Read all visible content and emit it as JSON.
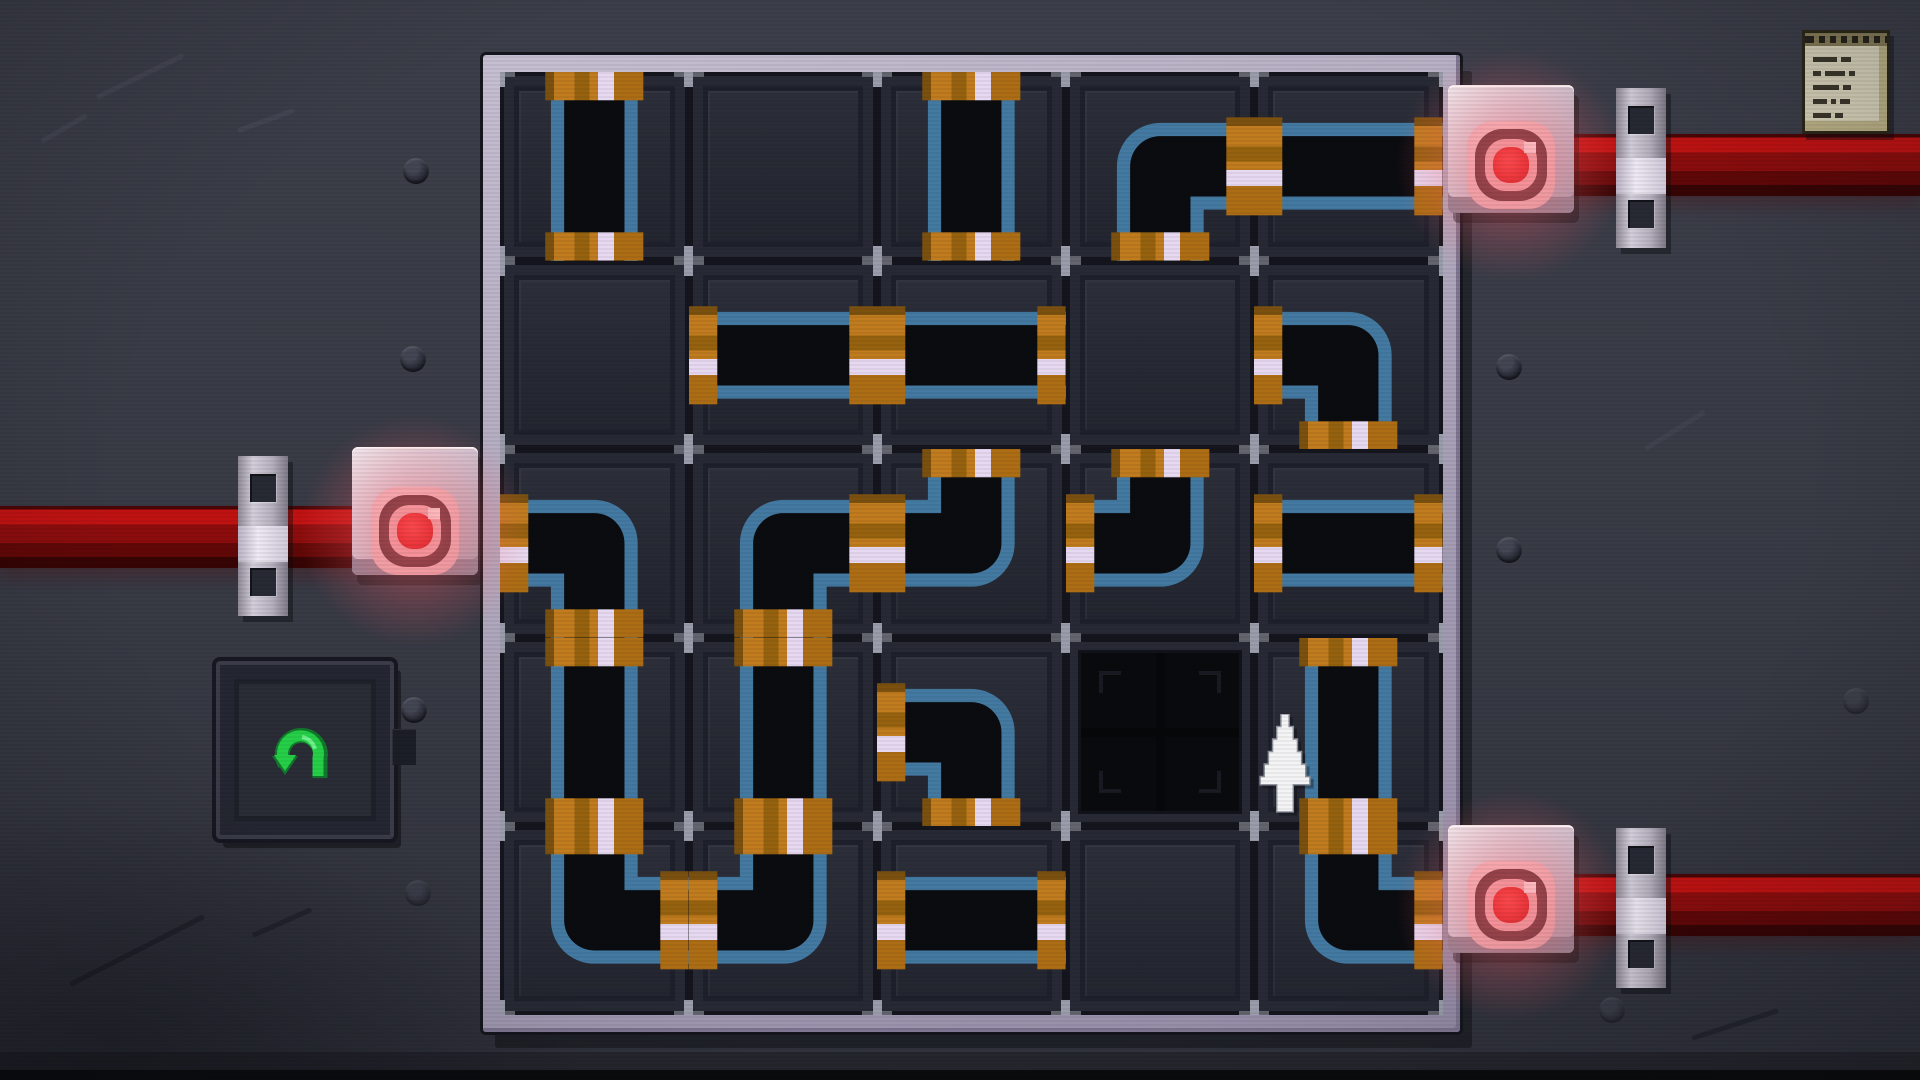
{
  "app": {
    "name": "pipe-connection-puzzle",
    "scene": "puzzle-board"
  },
  "board": {
    "rows": 5,
    "cols": 5,
    "pieces": [
      [
        "v",
        "empty",
        "v",
        "se",
        "h"
      ],
      [
        "empty",
        "h",
        "h",
        "empty",
        "sw"
      ],
      [
        "sw",
        "se",
        "nw",
        "nw",
        "h"
      ],
      [
        "v",
        "v",
        "sw",
        "hole",
        "v"
      ],
      [
        "ne",
        "nw",
        "h",
        "empty",
        "ne"
      ]
    ],
    "piece_legend": {
      "v": "vertical straight pipe",
      "h": "horizontal straight pipe",
      "ne": "elbow pipe connecting north and east",
      "nw": "elbow pipe connecting north and west",
      "se": "elbow pipe connecting south and east",
      "sw": "elbow pipe connecting south and west",
      "empty": "empty grid slot",
      "hole": "black missing-tile hole"
    }
  },
  "valves": [
    {
      "id": "valve-left",
      "side": "west",
      "grid_row": 2,
      "light_color": "#e01414"
    },
    {
      "id": "valve-top-right",
      "side": "east",
      "grid_row": 0,
      "light_color": "#e01414"
    },
    {
      "id": "valve-bottom-right",
      "side": "east",
      "grid_row": 4,
      "light_color": "#e01414"
    }
  ],
  "controls": {
    "undo_button": {
      "icon": "undo-arrow-icon",
      "color": "#2bd14b"
    },
    "notes": {
      "icon": "notes-icon"
    }
  },
  "cursor": {
    "icon": "cursor-up-arrow-icon",
    "near": "right edge of the missing-tile hole"
  },
  "colors": {
    "background": "#383a45",
    "grid_frame": "#b2abc0",
    "grid_gap": "#14151d",
    "cell": "#272a35",
    "pipe_edge_blue": "#447aa2",
    "pipe_interior": "#0b0c10",
    "coupling_orange": "#c07c1e",
    "coupling_stripe": "#e7d9f1",
    "supply_pipe_red": "#8d0d0d",
    "valve_light_red": "#e01414",
    "undo_green": "#2bd14b"
  }
}
